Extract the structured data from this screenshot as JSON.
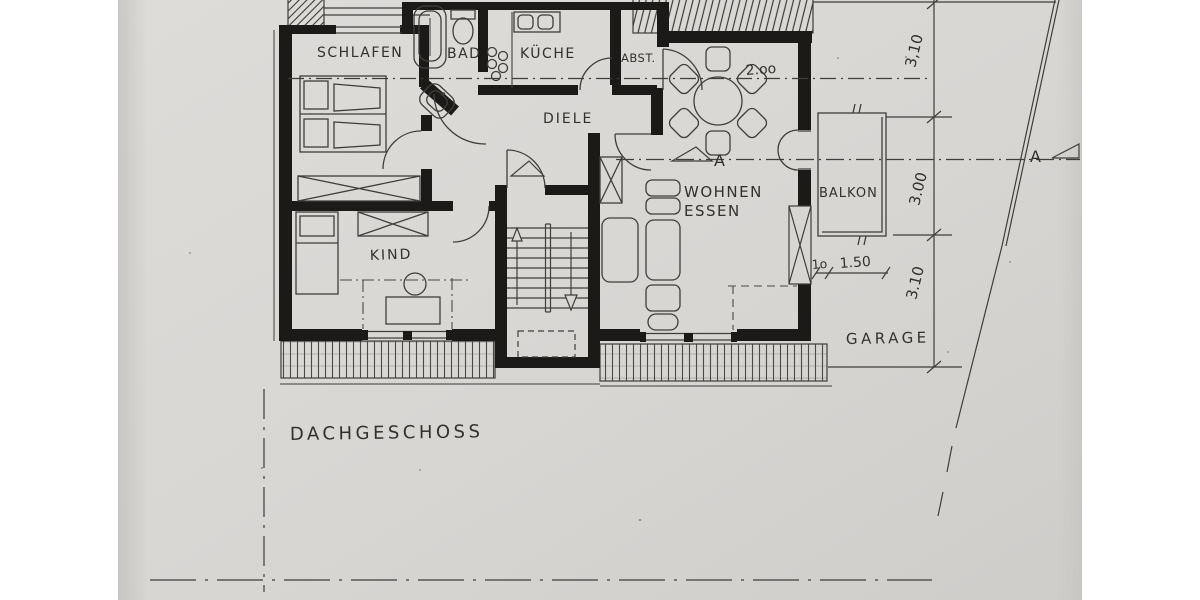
{
  "drawing": {
    "floor_label": "DACHGESCHOSS",
    "rooms": {
      "schlafen": "SCHLAFEN",
      "bad": "BAD",
      "kueche": "KÜCHE",
      "abst": "ABST.",
      "diele": "DIELE",
      "wohnen": "WOHNEN",
      "essen": "ESSEN",
      "kind": "KIND",
      "balkon": "BALKON"
    },
    "site": {
      "garage": "GARAGE"
    },
    "dimensions": {
      "right_top": "3,10",
      "right_mid": "3.00",
      "right_bottom": "3.10",
      "essen_width": "2.oo",
      "balcony_offset": "1o",
      "balcony_width": "1.50"
    },
    "section": {
      "mark_left": "A",
      "mark_right": "A"
    },
    "colors": {
      "paper": "#d8d6d3",
      "ink": "#3f3e3c",
      "wall": "#1b1a19"
    }
  }
}
